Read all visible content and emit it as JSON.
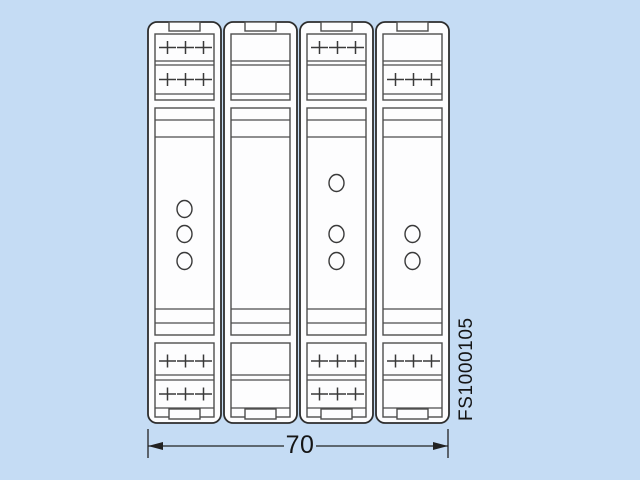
{
  "colors": {
    "background": "#c5dcf4",
    "module_fill": "#fdfdfe",
    "outline": "#2d2d2d",
    "inner_line": "#4d4d4d",
    "symbol": "#3a3a3a",
    "dimension": "#222222",
    "text": "#151515"
  },
  "drawing": {
    "canvas": {
      "width": 640,
      "height": 480
    },
    "module_geometry": {
      "y_top": 22,
      "width": 73,
      "height": 401,
      "corner_radius": 9,
      "inner_margin": 7,
      "tab": {
        "width": 31,
        "height": 9
      },
      "bottom_tab_y": 409,
      "bottom_tab_height": 10,
      "top_block": {
        "y1": 34,
        "y2": 100,
        "lines": [
          61,
          65,
          94
        ],
        "row_centers": [
          47.5,
          79.5
        ]
      },
      "body": {
        "y1": 108,
        "y2": 335,
        "lines": [
          120,
          137,
          309,
          323
        ]
      },
      "bottom_block": {
        "y1": 343,
        "y2": 417,
        "lines": [
          375,
          380,
          408
        ],
        "row_centers": [
          361,
          394
        ]
      },
      "plus_columns": [
        19.5,
        37.5,
        55.5
      ],
      "plus_arm": {
        "half_width": 8.5,
        "half_height": 6.5
      },
      "led_radius": {
        "rx": 7.5,
        "ry": 8.5
      }
    },
    "modules": [
      {
        "id": "module-1",
        "x": 148,
        "top_rows_plus": [
          true,
          true
        ],
        "bottom_rows_plus": [
          true,
          true
        ],
        "led_centers_y": [
          209,
          234,
          261
        ]
      },
      {
        "id": "module-2",
        "x": 224,
        "top_rows_plus": [
          false,
          false
        ],
        "bottom_rows_plus": [
          false,
          false
        ],
        "led_centers_y": []
      },
      {
        "id": "module-3",
        "x": 300,
        "top_rows_plus": [
          true,
          false
        ],
        "bottom_rows_plus": [
          true,
          true
        ],
        "led_centers_y": [
          183,
          234,
          261
        ]
      },
      {
        "id": "module-4",
        "x": 376,
        "top_rows_plus": [
          false,
          true
        ],
        "bottom_rows_plus": [
          true,
          false
        ],
        "led_centers_y": [
          234,
          261
        ]
      }
    ]
  },
  "dimension": {
    "label": "70",
    "x_start": 148,
    "x_end": 448,
    "line_y": 446,
    "extension_top": 429,
    "extension_bottom": 458,
    "label_gap": [
      284,
      316
    ],
    "arrow_length": 15,
    "arrow_half_height": 4
  },
  "part_number": {
    "text": "FS1000105"
  }
}
